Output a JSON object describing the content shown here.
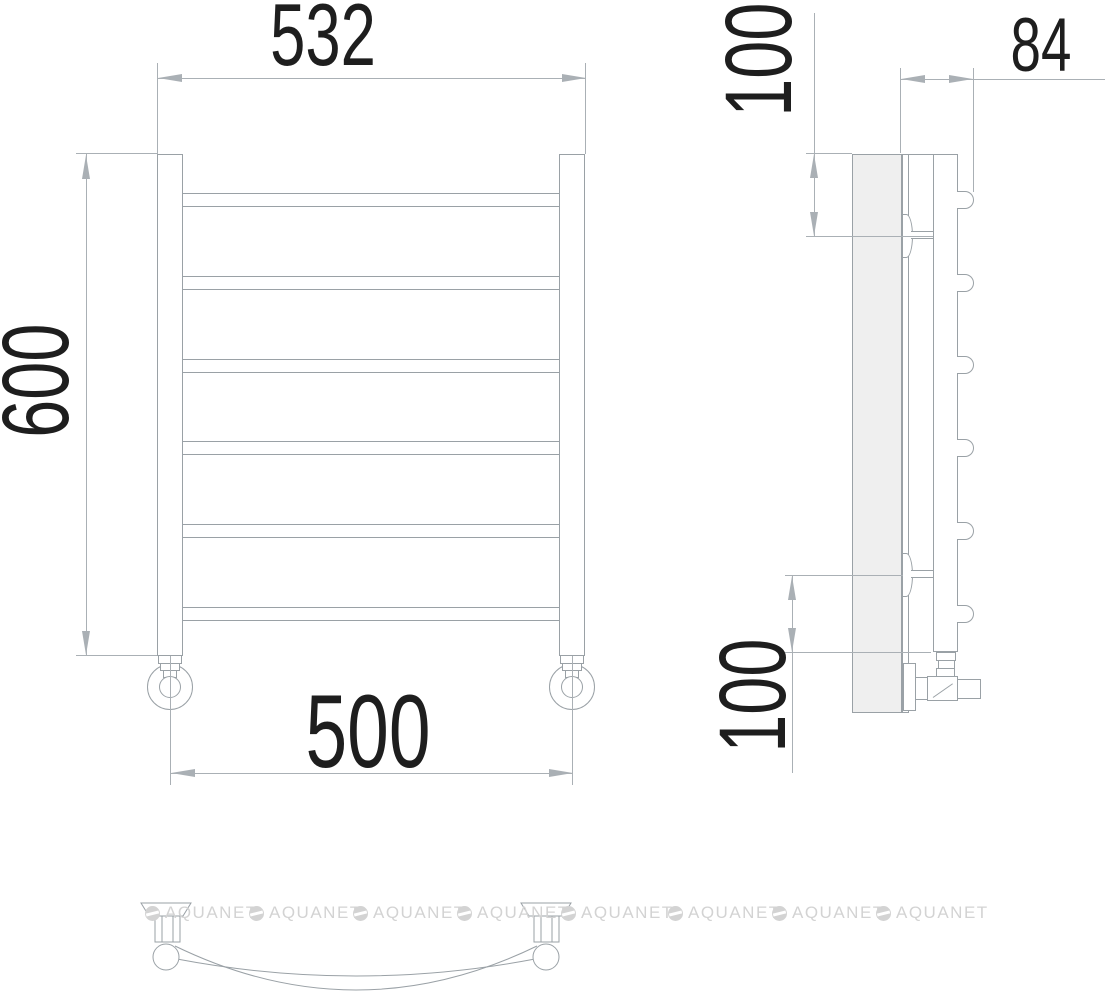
{
  "drawing": {
    "subject": "Curved 6-bar towel rail technical drawing: front, side and plan views",
    "dimensions": {
      "overall_width": "532",
      "height": "600",
      "mount_width": "500",
      "top_bracket_offset": "100",
      "wall_depth": "84",
      "bottom_bracket_offset": "100"
    },
    "counts": {
      "front_rails": 6,
      "side_rail_ends": 6,
      "wall_brackets": 2
    },
    "watermark": {
      "text": "AQUANET",
      "repeat": 8
    },
    "colors": {
      "part_line": "#9aa1a6",
      "dimension_line": "#aab0b5",
      "dimension_text": "#1e1e1e",
      "wall_fill": "#efefef",
      "watermark": "#d3d3d3"
    }
  }
}
